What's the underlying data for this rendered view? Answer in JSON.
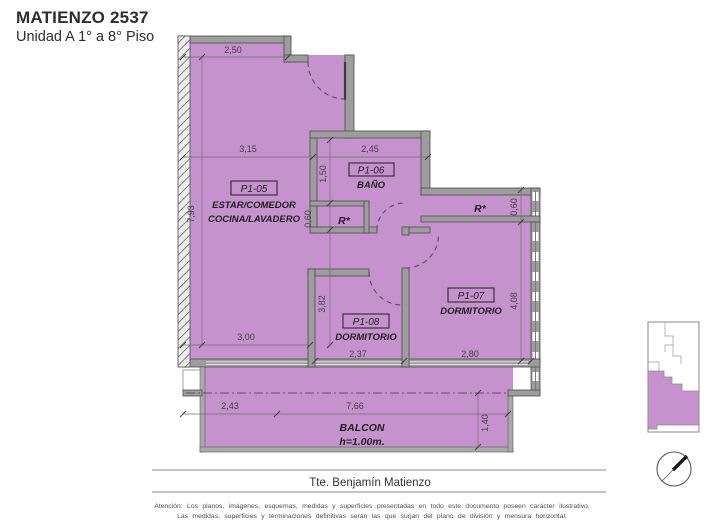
{
  "header": {
    "title": "MATIENZO 2537",
    "subtitle": "Unidad A 1° a 8° Piso"
  },
  "plan": {
    "rooms": {
      "living": {
        "code": "P1-05",
        "line1": "ESTAR/COMEDOR",
        "line2": "COCINA/LAVADERO"
      },
      "bath": {
        "code": "P1-06",
        "name": "BAÑO"
      },
      "bed1": {
        "code": "P1-07",
        "name": "DORMITORIO"
      },
      "bed2": {
        "code": "P1-08",
        "name": "DORMITORIO"
      }
    },
    "closet_label": "R*",
    "balcony": {
      "name": "BALCON",
      "height_note": "h=1.00m."
    },
    "dimensions": {
      "top_width": "2,50",
      "living_width": "3,15",
      "bath_width": "2,45",
      "bath_depth": "1,50",
      "bath_closet_depth": "0,60",
      "left_height": "7,93",
      "living_bottom_width": "3,00",
      "bed2_height": "3,82",
      "bed2_width": "2,37",
      "bed1_width": "2,80",
      "bed1_height": "4,08",
      "bed1_closet_depth": "0,60",
      "balcony_left": "2,43",
      "balcony_width": "7,66",
      "balcony_depth": "1,40"
    }
  },
  "street": {
    "name": "Tte. Benjamín Matienzo"
  },
  "footer": {
    "line1": "Atención: Los planos, imágenes, esquemas, medidas y superficies presentadas en todo este documento poseen carácter ilustrativo.",
    "line2": "Las medidas, superficies y terminaciones definitivas serán las que surjan del plano de división y mensura horizontal."
  },
  "colors": {
    "unit_fill": "#c692ce",
    "wall_fill": "#9d9d9d",
    "wall_edge": "#4c4c4c",
    "dim_text": "#3f3f3f"
  }
}
